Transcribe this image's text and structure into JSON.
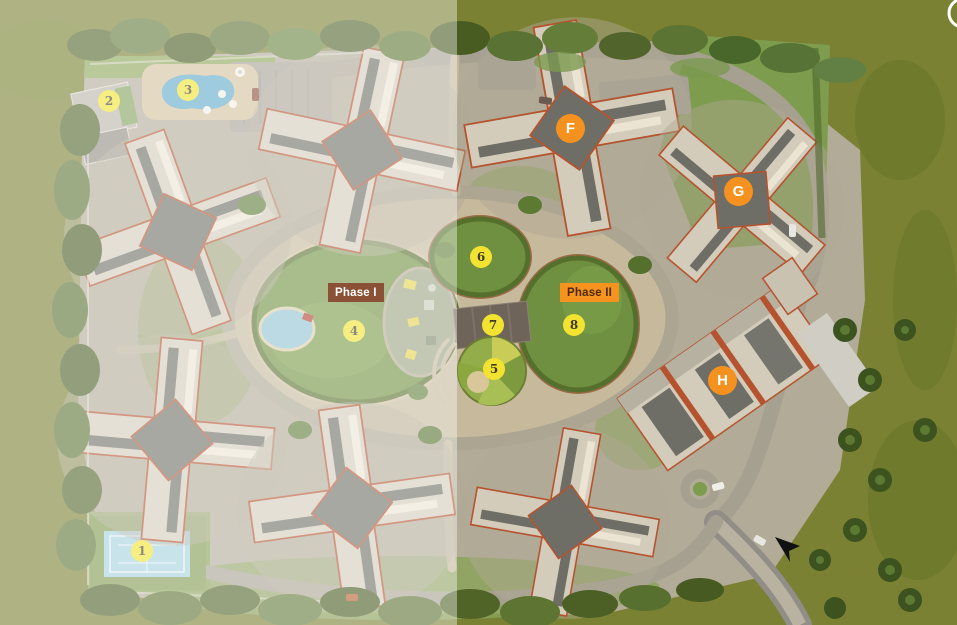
{
  "phases": {
    "phase_1": {
      "label": "Phase I",
      "bg": "#8a5136",
      "text_color": "#ffffff"
    },
    "phase_2": {
      "label": "Phase II",
      "bg": "#f6921e",
      "text_color": "#4a2a10"
    }
  },
  "markers": {
    "amenity_style": {
      "bg": "#f2e330",
      "text_color": "#3f3c2c",
      "shape": "circle"
    },
    "building_style": {
      "bg": "#f5911e",
      "text_color": "#ffffff",
      "shape": "circle"
    },
    "amenities": [
      {
        "label": "1"
      },
      {
        "label": "2"
      },
      {
        "label": "3"
      },
      {
        "label": "4"
      },
      {
        "label": "5"
      },
      {
        "label": "6"
      },
      {
        "label": "7"
      },
      {
        "label": "8"
      }
    ],
    "buildings": [
      {
        "label": "F"
      },
      {
        "label": "G"
      },
      {
        "label": "H"
      }
    ]
  },
  "icons": {
    "compass_ring": "white-circle-outline",
    "entry_arrow": "black-arrowhead"
  },
  "scene_colors": {
    "background_olive": "#7a8132",
    "fade_overlay": "rgba(255,255,255,0.40)",
    "lawn_green": "#6f9040",
    "hedge_green": "#55702c",
    "road_gray": "#a6a091",
    "park_ground_tan": "#c6b99c",
    "pool_blue": "#5fa8c8",
    "tennis_court_blue": "#a3d0dc",
    "roof_dark_gray": "#6f6e66",
    "building_wall_cream": "#d3ccba",
    "terracotta_trim": "#b5532f"
  }
}
